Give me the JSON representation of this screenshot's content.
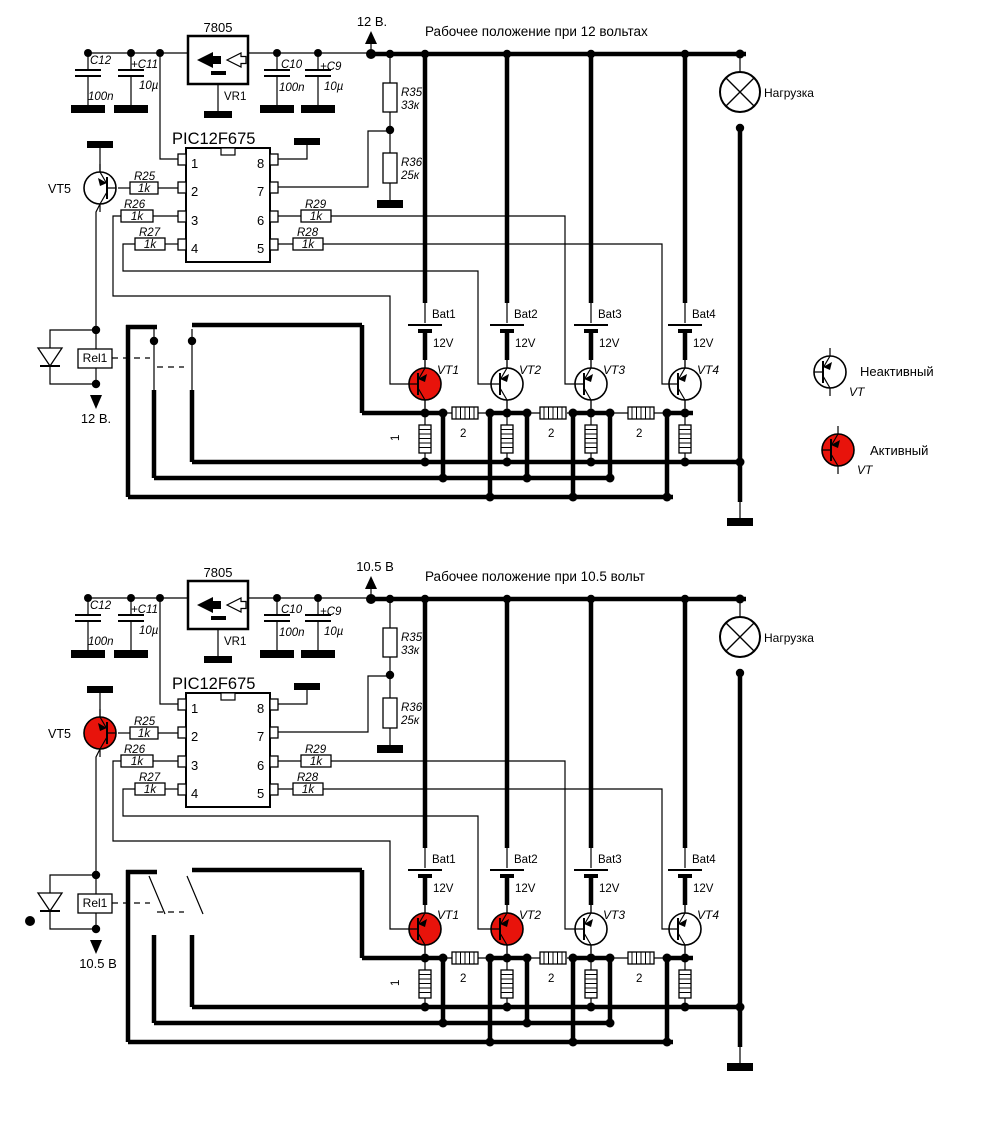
{
  "shared": {
    "c12": "C12",
    "c12_val": "100n",
    "c11": "+C11",
    "c11_val": "10µ",
    "c10": "C10",
    "c10_val": "100n",
    "c9": "+C9",
    "c9_val": "10µ",
    "regulator": "7805",
    "regulator_ref": "VR1",
    "mcu": "PIC12F675",
    "pin1": "1",
    "pin2": "2",
    "pin3": "3",
    "pin4": "4",
    "pin5": "5",
    "pin6": "6",
    "pin7": "7",
    "pin8": "8",
    "r25": "R25",
    "r25_val": "1k",
    "r26": "R26",
    "r26_val": "1k",
    "r27": "R27",
    "r27_val": "1k",
    "r28": "R28",
    "r28_val": "1k",
    "r29": "R29",
    "r29_val": "1k",
    "r35": "R35",
    "r35_val": "33к",
    "r36": "R36",
    "r36_val": "25к",
    "vt5": "VT5",
    "relay": "Rel1",
    "bat1": "Bat1",
    "bat2": "Bat2",
    "bat3": "Bat3",
    "bat4": "Bat4",
    "bat_v": "12V",
    "vt1": "VT1",
    "vt2": "VT2",
    "vt3": "VT3",
    "vt4": "VT4",
    "coil1": "1",
    "coil2": "2",
    "load": "Нагрузка"
  },
  "legend": {
    "inactive_label": "Неактивный",
    "active_label": "Активный",
    "vt": "VT",
    "inactive_color": "#ffffff",
    "active_color": "#e8130b"
  },
  "top": {
    "title": "Рабочее положение при 12 вольтах",
    "supply": "12 В.",
    "relay_voltage": "12 В.",
    "vt1_color": "#e8130b",
    "vt2_color": "#ffffff",
    "vt3_color": "#ffffff",
    "vt4_color": "#ffffff",
    "vt5_color": "#ffffff",
    "contacts_closed": "visible",
    "contacts_open": "hidden",
    "aux_dot": "hidden"
  },
  "bottom": {
    "title": "Рабочее положение при 10.5 вольт",
    "supply": "10.5 В",
    "relay_voltage": "10.5 В",
    "vt1_color": "#e8130b",
    "vt2_color": "#e8130b",
    "vt3_color": "#ffffff",
    "vt4_color": "#ffffff",
    "vt5_color": "#e8130b",
    "contacts_closed": "hidden",
    "contacts_open": "visible",
    "aux_dot": "visible"
  }
}
